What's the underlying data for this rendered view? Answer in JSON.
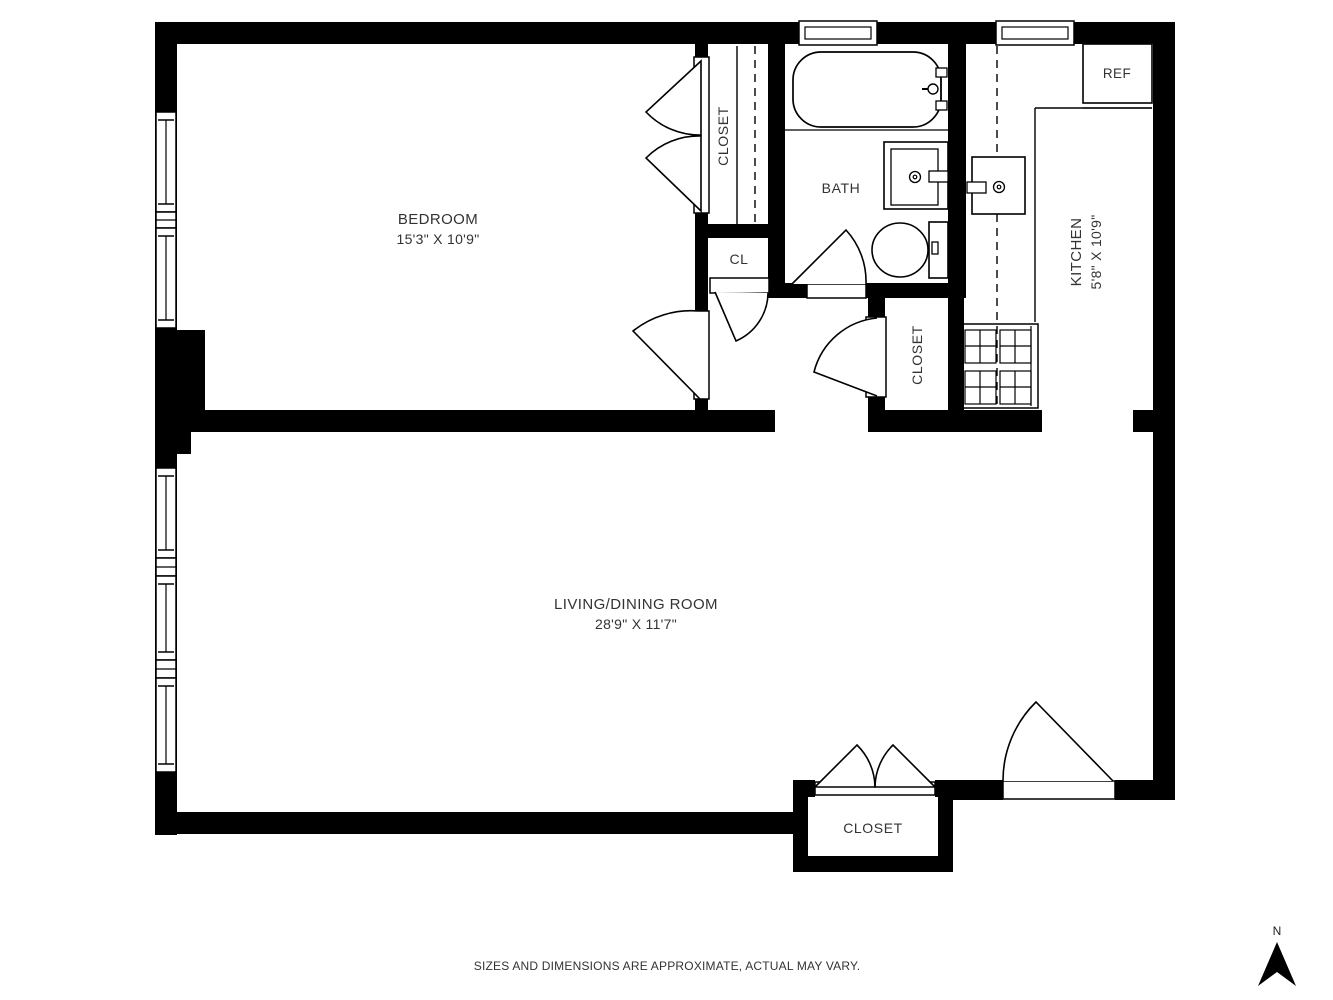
{
  "meta": {
    "footer_disclaimer": "SIZES AND DIMENSIONS ARE APPROXIMATE, ACTUAL MAY VARY."
  },
  "compass": {
    "north_label": "N"
  },
  "rooms": {
    "bedroom": {
      "name": "BEDROOM",
      "dims": "15'3\" X 10'9\""
    },
    "living_dining": {
      "name": "LIVING/DINING ROOM",
      "dims": "28'9\" X 11'7\""
    },
    "kitchen": {
      "name": "KITCHEN",
      "dims": "5'8\" X 10'9\""
    },
    "bath": {
      "name": "BATH"
    },
    "bedroom_closet": {
      "name": "CLOSET"
    },
    "hall_closet": {
      "name": "CLOSET"
    },
    "entry_closet": {
      "name": "CLOSET"
    },
    "small_closet": {
      "name": "CL"
    },
    "refrigerator": {
      "name": "REF"
    }
  },
  "colors": {
    "wall": "#000000",
    "text": "#333333",
    "background": "#ffffff"
  }
}
